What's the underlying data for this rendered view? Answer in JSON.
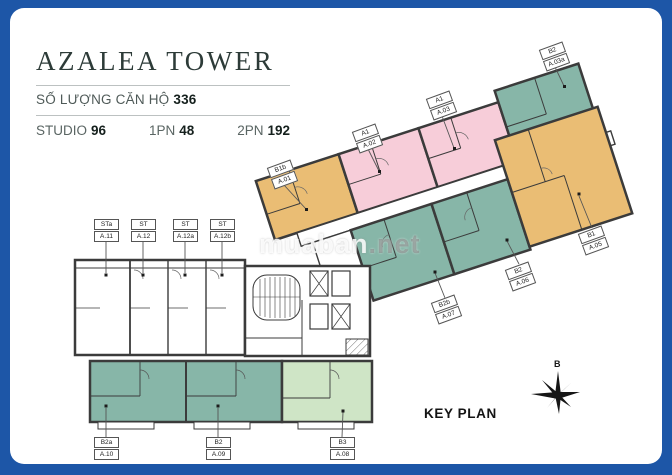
{
  "frame": {
    "border_color": "#1d56a7",
    "background": "#ffffff"
  },
  "header": {
    "title": "AZALEA TOWER",
    "units_count_label": "SỐ LƯỢNG CĂN HỘ",
    "units_count_value": "336",
    "stats": [
      {
        "label": "STUDIO",
        "value": "96"
      },
      {
        "label": "1PN",
        "value": "48"
      },
      {
        "label": "2PN",
        "value": "192"
      }
    ]
  },
  "plan": {
    "key_plan_label": "KEY PLAN",
    "compass_letter": "B",
    "colors": {
      "orange_unit": "#eabd74",
      "pink_unit": "#f7cdd9",
      "teal_unit": "#87b6a8",
      "green_unit": "#cfe5c6",
      "wall": "#3b3b3b"
    },
    "units": [
      {
        "type": "STa",
        "number": "A.11",
        "category": "studio"
      },
      {
        "type": "ST",
        "number": "A.12",
        "category": "studio"
      },
      {
        "type": "ST",
        "number": "A.12a",
        "category": "studio"
      },
      {
        "type": "ST",
        "number": "A.12b",
        "category": "studio"
      },
      {
        "type": "B1b",
        "number": "A.01",
        "category": "orange"
      },
      {
        "type": "A1",
        "number": "A.02",
        "category": "pink"
      },
      {
        "type": "A1",
        "number": "A.03",
        "category": "pink"
      },
      {
        "type": "B2",
        "number": "A.03a",
        "category": "teal"
      },
      {
        "type": "B1",
        "number": "A.05",
        "category": "orange"
      },
      {
        "type": "B2",
        "number": "A.06",
        "category": "teal"
      },
      {
        "type": "B2b",
        "number": "A.07",
        "category": "teal"
      },
      {
        "type": "B3",
        "number": "A.08",
        "category": "green"
      },
      {
        "type": "B2",
        "number": "A.09",
        "category": "teal"
      },
      {
        "type": "B2a",
        "number": "A.10",
        "category": "teal"
      }
    ]
  },
  "watermark": {
    "main": "muaban",
    "suffix": ".net"
  }
}
